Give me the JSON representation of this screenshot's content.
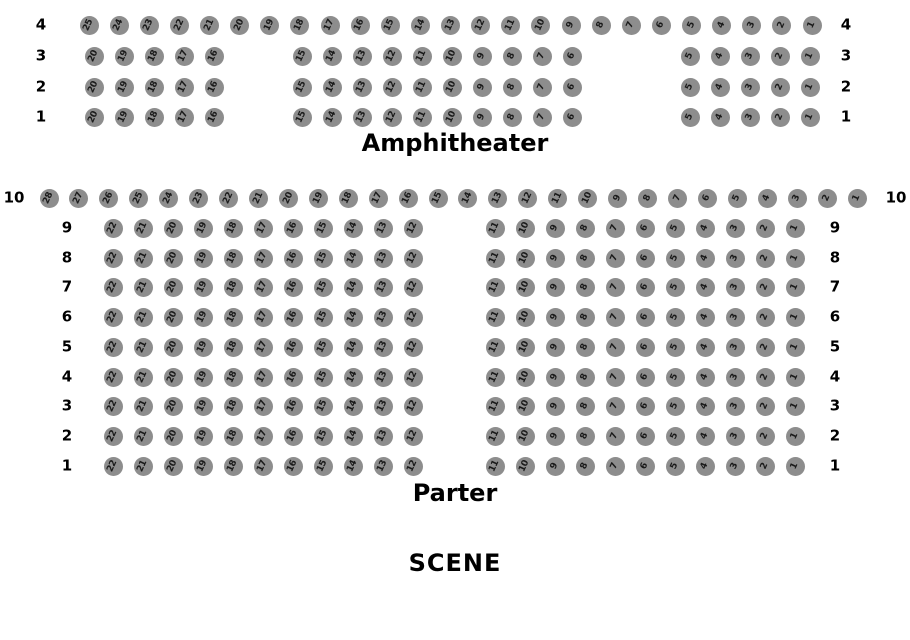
{
  "colors": {
    "background": "#ffffff",
    "seat_fill": "#8d8d8d",
    "seat_number": "#1a1a1a",
    "label_text": "#000000"
  },
  "stage": {
    "label": "SCENE"
  },
  "sections": [
    {
      "id": "amphitheater",
      "title": "Amphitheater",
      "rows": [
        {
          "label": "4",
          "groups": [
            [
              25,
              24,
              23,
              22,
              21,
              20,
              19,
              18,
              17,
              16,
              15,
              14,
              13,
              12,
              11,
              10,
              9,
              8,
              7,
              6,
              5,
              4,
              3,
              2,
              1
            ]
          ]
        },
        {
          "label": "3",
          "groups": [
            [
              20,
              19,
              18,
              17,
              16
            ],
            [
              15,
              14,
              13,
              12,
              11,
              10,
              9,
              8,
              7,
              6
            ],
            [
              5,
              4,
              3,
              2,
              1
            ]
          ]
        },
        {
          "label": "2",
          "groups": [
            [
              20,
              19,
              18,
              17,
              16
            ],
            [
              15,
              14,
              13,
              12,
              11,
              10,
              9,
              8,
              7,
              6
            ],
            [
              5,
              4,
              3,
              2,
              1
            ]
          ]
        },
        {
          "label": "1",
          "groups": [
            [
              20,
              19,
              18,
              17,
              16
            ],
            [
              15,
              14,
              13,
              12,
              11,
              10,
              9,
              8,
              7,
              6
            ],
            [
              5,
              4,
              3,
              2,
              1
            ]
          ]
        }
      ]
    },
    {
      "id": "parter",
      "title": "Parter",
      "rows": [
        {
          "label": "10",
          "groups": [
            [
              28,
              27,
              26,
              25,
              24,
              23,
              22,
              21,
              20,
              19,
              18,
              17,
              16,
              15,
              14,
              13,
              12,
              11,
              10,
              9,
              8,
              7,
              6,
              5,
              4,
              3,
              2,
              1
            ]
          ]
        },
        {
          "label": "9",
          "groups": [
            [
              22,
              21,
              20,
              19,
              18,
              17,
              16,
              15,
              14,
              13,
              12
            ],
            [
              11,
              10,
              9,
              8,
              7,
              6,
              5,
              4,
              3,
              2,
              1
            ]
          ]
        },
        {
          "label": "8",
          "groups": [
            [
              22,
              21,
              20,
              19,
              18,
              17,
              16,
              15,
              14,
              13,
              12
            ],
            [
              11,
              10,
              9,
              8,
              7,
              6,
              5,
              4,
              3,
              2,
              1
            ]
          ]
        },
        {
          "label": "7",
          "groups": [
            [
              22,
              21,
              20,
              19,
              18,
              17,
              16,
              15,
              14,
              13,
              12
            ],
            [
              11,
              10,
              9,
              8,
              7,
              6,
              5,
              4,
              3,
              2,
              1
            ]
          ]
        },
        {
          "label": "6",
          "groups": [
            [
              22,
              21,
              20,
              19,
              18,
              17,
              16,
              15,
              14,
              13,
              12
            ],
            [
              11,
              10,
              9,
              8,
              7,
              6,
              5,
              4,
              3,
              2,
              1
            ]
          ]
        },
        {
          "label": "5",
          "groups": [
            [
              22,
              21,
              20,
              19,
              18,
              17,
              16,
              15,
              14,
              13,
              12
            ],
            [
              11,
              10,
              9,
              8,
              7,
              6,
              5,
              4,
              3,
              2,
              1
            ]
          ]
        },
        {
          "label": "4",
          "groups": [
            [
              22,
              21,
              20,
              19,
              18,
              17,
              16,
              15,
              14,
              13,
              12
            ],
            [
              11,
              10,
              9,
              8,
              7,
              6,
              5,
              4,
              3,
              2,
              1
            ]
          ]
        },
        {
          "label": "3",
          "groups": [
            [
              22,
              21,
              20,
              19,
              18,
              17,
              16,
              15,
              14,
              13,
              12
            ],
            [
              11,
              10,
              9,
              8,
              7,
              6,
              5,
              4,
              3,
              2,
              1
            ]
          ]
        },
        {
          "label": "2",
          "groups": [
            [
              22,
              21,
              20,
              19,
              18,
              17,
              16,
              15,
              14,
              13,
              12
            ],
            [
              11,
              10,
              9,
              8,
              7,
              6,
              5,
              4,
              3,
              2,
              1
            ]
          ]
        },
        {
          "label": "1",
          "groups": [
            [
              22,
              21,
              20,
              19,
              18,
              17,
              16,
              15,
              14,
              13,
              12
            ],
            [
              11,
              10,
              9,
              8,
              7,
              6,
              5,
              4,
              3,
              2,
              1
            ]
          ]
        }
      ]
    }
  ]
}
